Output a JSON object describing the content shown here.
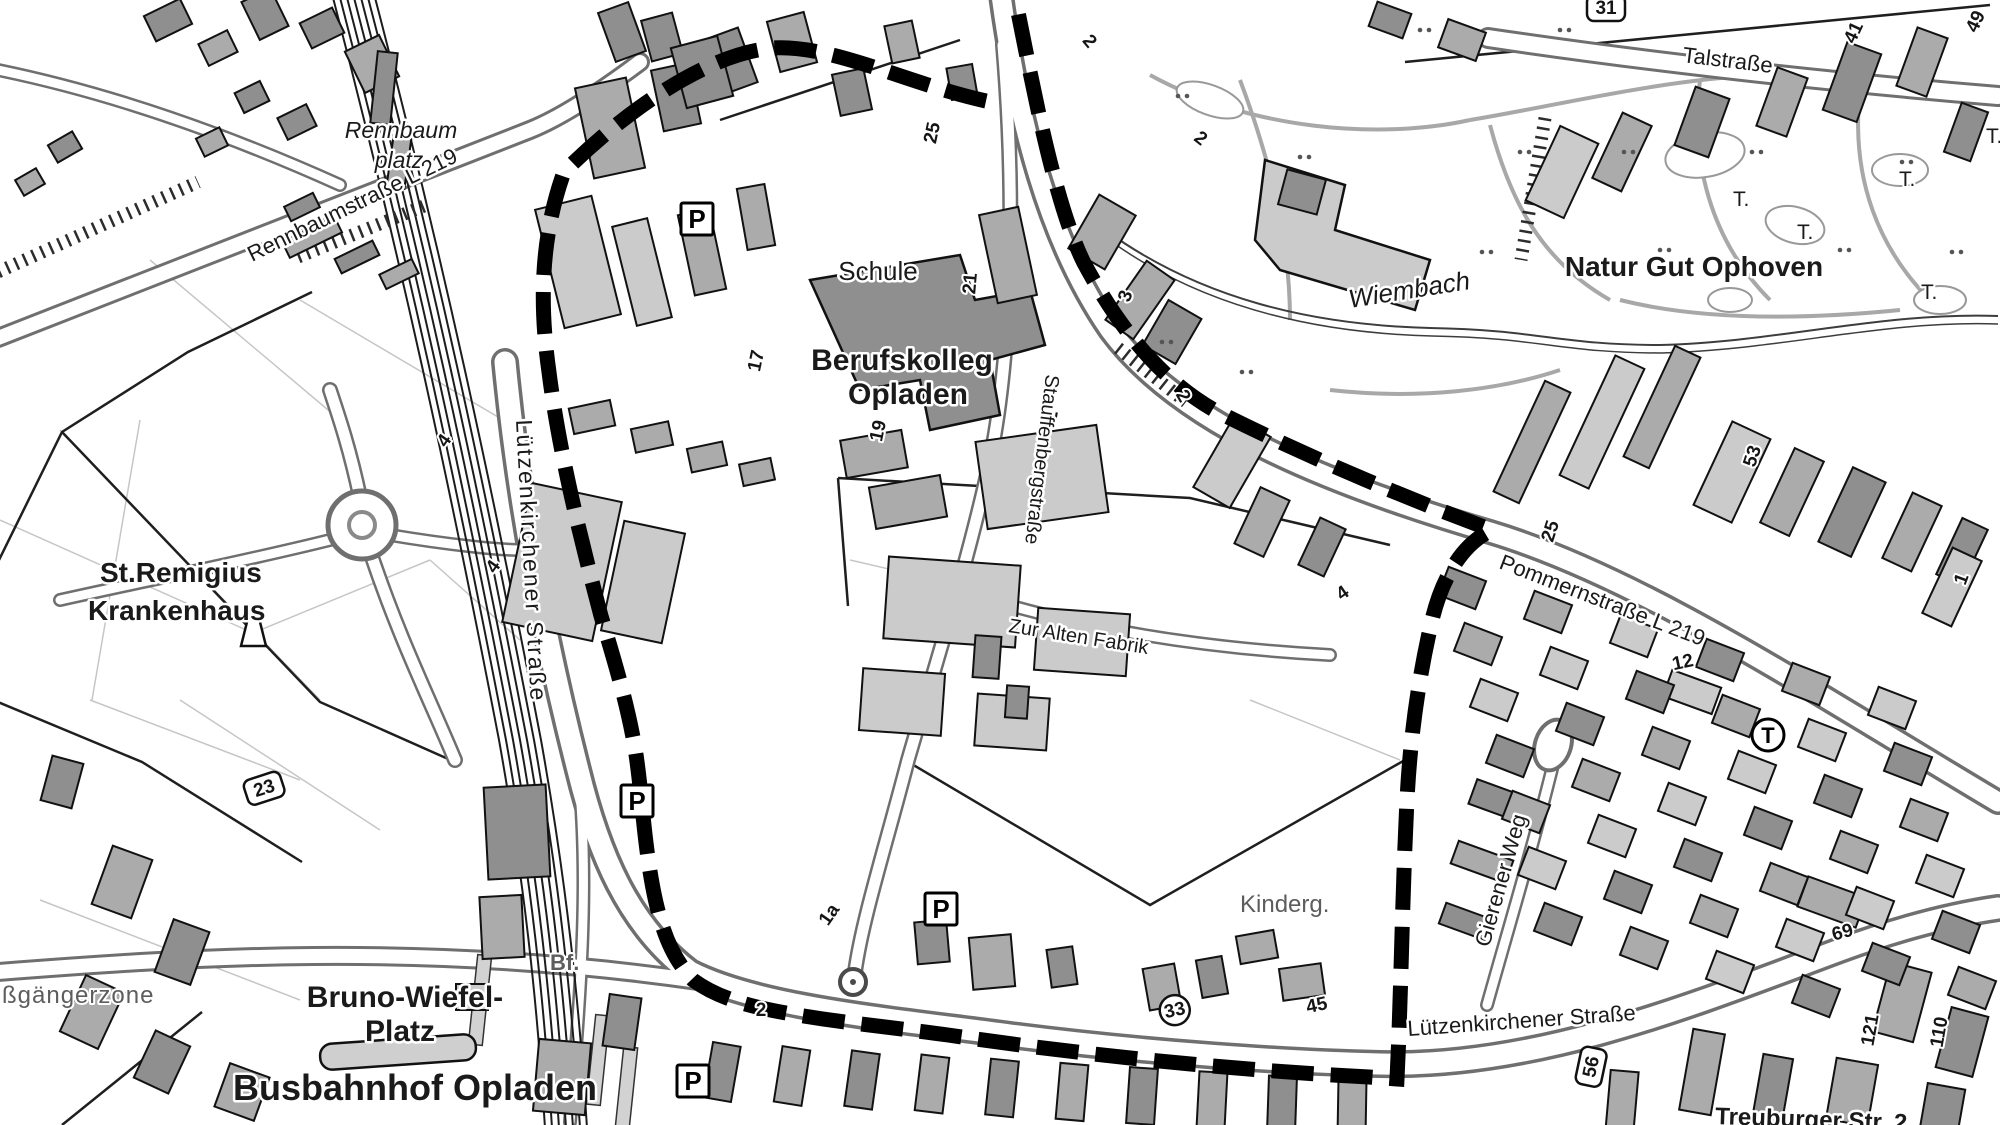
{
  "map": {
    "region_labels": {
      "rennbaumplatz_line1": "Rennbaum",
      "rennbaumplatz_line2": "platz",
      "st_remigius_line1": "St.Remigius",
      "st_remigius_line2": "Krankenhaus",
      "schule": "Schule",
      "berufskolleg_line1": "Berufskolleg",
      "berufskolleg_line2": "Opladen",
      "natur_gut_ophoven": "Natur Gut Ophoven",
      "wiembach": "Wiembach",
      "bruno_wiefel_line1": "Bruno-Wiefel-",
      "bruno_wiefel_line2": "Platz",
      "busbahnhof": "Busbahnhof Opladen",
      "fussgaengerzone": "ßgängerzone",
      "kindergarten": "Kinderg.",
      "bahnhof": "Bf."
    },
    "street_labels": {
      "rennbaumstrasse": "Rennbaumstraße L 219",
      "talstrasse": "Talstraße",
      "pommernstrasse": "Pommernstraße L 219",
      "luetzenkirchener_west": "Lützenkirchener Straße",
      "luetzenkirchener_sued": "Lützenkirchener Straße",
      "stauffenbergstrasse": "Stauffenbergstraße",
      "zur_alten_fabrik": "Zur Alten Fabrik",
      "gierener_weg": "Gierener Weg",
      "treuburger_strasse": "Treuburger Str. 2"
    },
    "icons": {
      "parking": "P",
      "tram_stop": "T",
      "tree_mark": "T."
    },
    "markers": {
      "parking_positions": [
        {
          "x": 697,
          "y": 219
        },
        {
          "x": 637,
          "y": 801
        },
        {
          "x": 693,
          "y": 1081
        },
        {
          "x": 941,
          "y": 909
        }
      ],
      "tram_stop_positions": [
        {
          "x": 1768,
          "y": 735
        }
      ],
      "tree_mark_positions": [
        {
          "x": 1733,
          "y": 206
        },
        {
          "x": 1797,
          "y": 239
        },
        {
          "x": 1899,
          "y": 186
        },
        {
          "x": 1921,
          "y": 299
        },
        {
          "x": 1986,
          "y": 143
        }
      ],
      "house_numbers": [
        {
          "text": "25",
          "x": 938,
          "y": 134,
          "r": -78,
          "shape": "plain"
        },
        {
          "text": "17",
          "x": 762,
          "y": 362,
          "r": -78,
          "shape": "plain"
        },
        {
          "text": "19",
          "x": 884,
          "y": 432,
          "r": -78,
          "shape": "plain"
        },
        {
          "text": "21",
          "x": 976,
          "y": 284,
          "r": -85,
          "shape": "plain"
        },
        {
          "text": "3",
          "x": 1131,
          "y": 298,
          "r": -70,
          "shape": "plain"
        },
        {
          "text": "2",
          "x": 1197,
          "y": 143,
          "r": 38,
          "shape": "plain"
        },
        {
          "text": "2",
          "x": 1178,
          "y": 399,
          "r": 60,
          "shape": "plain"
        },
        {
          "text": "2",
          "x": 1057,
          "y": 417,
          "r": -80,
          "shape": "plain"
        },
        {
          "text": "2",
          "x": 1085,
          "y": 45,
          "r": 50,
          "shape": "plain"
        },
        {
          "text": "4",
          "x": 1346,
          "y": 598,
          "r": -35,
          "shape": "plain"
        },
        {
          "text": "4",
          "x": 449,
          "y": 444,
          "r": -55,
          "shape": "plain"
        },
        {
          "text": "4",
          "x": 498,
          "y": 570,
          "r": -55,
          "shape": "plain"
        },
        {
          "text": "25",
          "x": 1556,
          "y": 533,
          "r": -72,
          "shape": "plain"
        },
        {
          "text": "53",
          "x": 1758,
          "y": 458,
          "r": -72,
          "shape": "plain"
        },
        {
          "text": "1",
          "x": 1967,
          "y": 581,
          "r": -70,
          "shape": "plain"
        },
        {
          "text": "12",
          "x": 1684,
          "y": 668,
          "r": -12,
          "shape": "plain"
        },
        {
          "text": "41",
          "x": 1859,
          "y": 35,
          "r": -65,
          "shape": "plain"
        },
        {
          "text": "49",
          "x": 1981,
          "y": 24,
          "r": -65,
          "shape": "plain"
        },
        {
          "text": "1a",
          "x": 834,
          "y": 918,
          "r": -55,
          "shape": "plain"
        },
        {
          "text": "2",
          "x": 761,
          "y": 1016,
          "r": 0,
          "shape": "plain"
        },
        {
          "text": "69",
          "x": 1844,
          "y": 938,
          "r": -15,
          "shape": "plain"
        },
        {
          "text": "45",
          "x": 1318,
          "y": 1011,
          "r": -12,
          "shape": "plain"
        },
        {
          "text": "121",
          "x": 1876,
          "y": 1031,
          "r": -80,
          "shape": "plain"
        },
        {
          "text": "110",
          "x": 1945,
          "y": 1033,
          "r": -80,
          "shape": "plain"
        },
        {
          "text": "33",
          "x": 1176,
          "y": 1016,
          "r": -12,
          "shape": "circle"
        },
        {
          "text": "23",
          "x": 266,
          "y": 794,
          "r": -18,
          "shape": "box"
        },
        {
          "text": "56",
          "x": 1597,
          "y": 1068,
          "r": -78,
          "shape": "box"
        },
        {
          "text": "31",
          "x": 1606,
          "y": 14,
          "r": 0,
          "shape": "box"
        }
      ]
    },
    "colors": {
      "plan_boundary": "#000000",
      "building_dark": "#8f8f8f",
      "building_mid": "#ababab",
      "building_light": "#cbcbcb",
      "road_casing": "#6f6f6f",
      "label_text": "#1a1a1a",
      "muted_text": "#5d5d5d"
    }
  }
}
